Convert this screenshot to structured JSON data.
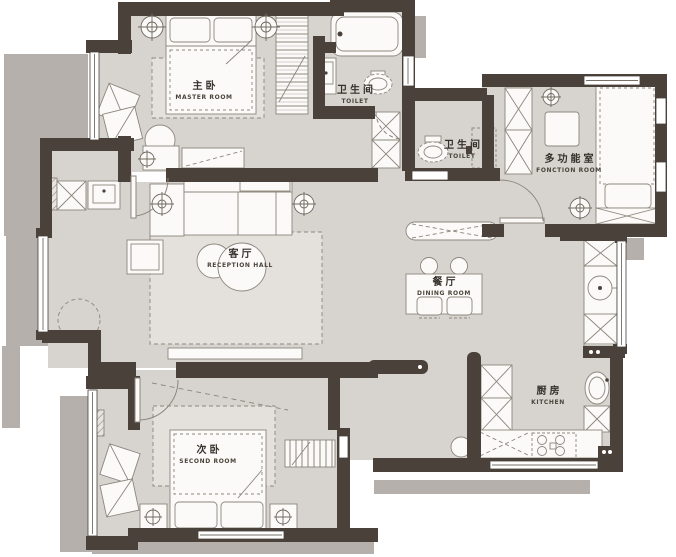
{
  "title": "apartment floor plan",
  "colors": {
    "background": "#ffffff",
    "wall": "#49413a",
    "floor": "#d7d4cf",
    "rug": "#dedbd6",
    "shadow": "#b5b0ac",
    "furniture_fill": "#fbfaf8",
    "furniture_stroke": "#8c867d",
    "label_text": "#35302a"
  },
  "rooms": [
    {
      "id": "master-room",
      "label_zh": "主卧",
      "label_en": "MASTER ROOM"
    },
    {
      "id": "toilet-main",
      "label_zh": "卫生间",
      "label_en": "TOILET"
    },
    {
      "id": "toilet-guest",
      "label_zh": "卫生间",
      "label_en": "TOILET"
    },
    {
      "id": "function-room",
      "label_zh": "多功能室",
      "label_en": "FONCTION ROOM"
    },
    {
      "id": "reception-hall",
      "label_zh": "客厅",
      "label_en": "RECEPTION HALL"
    },
    {
      "id": "dining-room",
      "label_zh": "餐厅",
      "label_en": "DINING ROOM"
    },
    {
      "id": "second-room",
      "label_zh": "次卧",
      "label_en": "SECOND ROOM"
    },
    {
      "id": "kitchen",
      "label_zh": "厨房",
      "label_en": "KITCHEN"
    }
  ],
  "fixtures": [
    "double-bed",
    "single-bed",
    "wardrobe",
    "bathtub",
    "toilet",
    "wash-basin",
    "sofa",
    "round-rug",
    "dining-table",
    "chairs",
    "sideboard",
    "desk",
    "washing-machine",
    "kitchen-sink",
    "gas-stove",
    "storage-cabinet",
    "lounge-chair",
    "nightstand",
    "bookshelf",
    "ceiling-light"
  ]
}
